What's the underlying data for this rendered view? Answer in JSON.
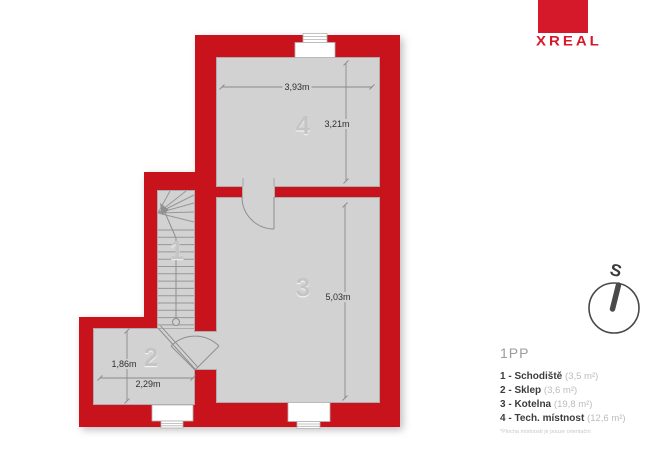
{
  "brand": {
    "name": "XREAL"
  },
  "compass": {
    "direction_label": "S"
  },
  "plan": {
    "colors": {
      "wall": "#c8121c",
      "floor": "#d2d2d2"
    },
    "rooms": [
      {
        "number": "1"
      },
      {
        "number": "2"
      },
      {
        "number": "3"
      },
      {
        "number": "4"
      }
    ],
    "dims": {
      "room4_width": "3,93m",
      "room4_height": "3,21m",
      "room3_height": "5,03m",
      "room2_height": "1,86m",
      "room2_width": "2,29m"
    }
  },
  "legend": {
    "floor_label": "1PP",
    "items": [
      {
        "prefix": "1 - Schodiště",
        "area": "(3,5 m²)"
      },
      {
        "prefix": "2 - Sklep",
        "area": "(3,6 m²)"
      },
      {
        "prefix": "3 - Kotelna",
        "area": "(19,8 m²)"
      },
      {
        "prefix": "4 - Tech. místnost",
        "area": "(12,6 m²)"
      }
    ],
    "footnote": "*Plocha místností je pouze orientační"
  }
}
